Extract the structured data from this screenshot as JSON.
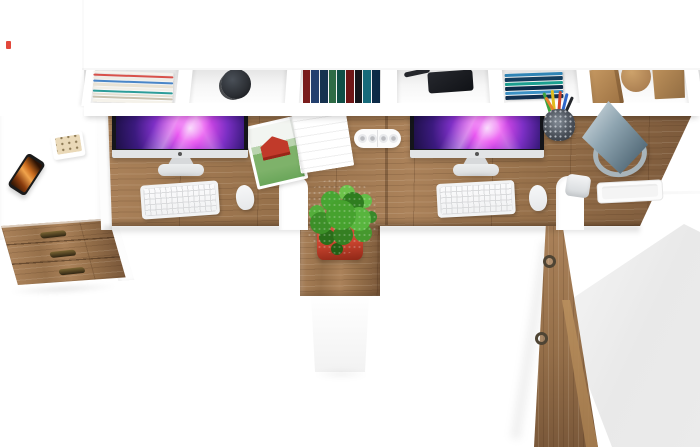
{
  "meta": {
    "subject": "Top-down product photo of a two-person white and oak office desk set with hutch shelving, two iMac computers, plant pedestal, drawer unit and tall side cabinet",
    "visible_text": ""
  },
  "palette": {
    "bg": "#ffffff",
    "wood_hi": "#ab825a",
    "wood_mid": "#96704a",
    "wood_lo": "#7a583a",
    "bezel": "#14151a",
    "imac_silver": "#e2e4e6",
    "stand_silver": "#eceeef",
    "screen_deep": "#1d1046",
    "screen_violet": "#7b2fc4",
    "screen_magenta": "#e94df0",
    "screen_glow": "#f7c8fb",
    "keyboard": "#f2f3f4",
    "mouse": "#f6f7f8",
    "lamp_hi": "#ccd7dd",
    "lamp_mid": "#8ea4b0",
    "lamp_lo": "#526977",
    "lamp_ring": "#a8b4ba",
    "plant_mid": "#46a22e",
    "pot_red": "#c8432e",
    "clip_red": "#c4402c",
    "barn_red": "#c13a2a",
    "field_green": "#7eb26a",
    "treeline_green": "#b9d4ae",
    "sky_white": "#f2f5f1",
    "phone_body": "#1a1a1a",
    "phone_amber": "#d9812f",
    "mug": "#2b2e33",
    "block_tan_hi": "#c79a63",
    "block_tan_lo": "#9c7142",
    "handle_dark": "#46351c",
    "ring_metal": "#4e4434",
    "gray_plane": "#ebebeb",
    "powerstrip": "#fbfbfb",
    "calc_body": "#ead9b8",
    "watermark_red": "#e2483b"
  },
  "series": {
    "magazine_edges": [
      "#f6f3ec",
      "#d8514a",
      "#efece4",
      "#4a86c8",
      "#e8e2d4",
      "#f2efe7",
      "#2e9d9a",
      "#e5e0d2",
      "#c9c2b0",
      "#f5f2ea"
    ],
    "book_spines": [
      "#7a1d1d",
      "#24406e",
      "#16324f",
      "#2e6b45",
      "#0f4f46",
      "#6e1616",
      "#14161c",
      "#176a7a",
      "#0d2b47"
    ],
    "blue_stack": [
      "#2f84b5",
      "#143e5e",
      "#1b9e8f",
      "#0e2c49",
      "#3b90c4",
      "#122f4f"
    ],
    "pencils": [
      "#3fa33f",
      "#e0bd1f",
      "#d0452a",
      "#2e66c9",
      "#24262b",
      "#e8842b"
    ]
  },
  "objects": [
    {
      "id": "hutch-top-panel",
      "label": "white hutch top panel"
    },
    {
      "id": "hutch-compartments",
      "label": "open shelf compartment row"
    },
    {
      "id": "magazine-stack",
      "label": "stack of magazines lying flat"
    },
    {
      "id": "coffee-mug",
      "label": "dark mug seen from above"
    },
    {
      "id": "book-row",
      "label": "row of standing books"
    },
    {
      "id": "black-case",
      "label": "black case on shelf"
    },
    {
      "id": "cable",
      "label": "dark cable end"
    },
    {
      "id": "blue-book-stack",
      "label": "stack of blue books"
    },
    {
      "id": "wood-block-cube",
      "label": "wooden cube ornament"
    },
    {
      "id": "wood-block-cylinder",
      "label": "wooden cylinder ornament"
    },
    {
      "id": "wood-block-wedge",
      "label": "wooden wedge ornament"
    },
    {
      "id": "left-side-desk",
      "label": "white side return desk"
    },
    {
      "id": "smartphone",
      "label": "smartphone with amber screen"
    },
    {
      "id": "notepad",
      "label": "small white pad"
    },
    {
      "id": "calculator",
      "label": "cream desk calculator"
    },
    {
      "id": "wood-desktop",
      "label": "oak double desktop"
    },
    {
      "id": "imac-left",
      "label": "left all-in-one computer"
    },
    {
      "id": "imac-right",
      "label": "right all-in-one computer"
    },
    {
      "id": "keyboard-left",
      "label": "white keyboard"
    },
    {
      "id": "keyboard-right",
      "label": "white keyboard"
    },
    {
      "id": "mouse-left",
      "label": "white mouse"
    },
    {
      "id": "mouse-right",
      "label": "white mouse"
    },
    {
      "id": "open-magazine",
      "label": "open magazine with red barn photo"
    },
    {
      "id": "power-strip",
      "label": "white power strip"
    },
    {
      "id": "pencil-cup",
      "label": "mesh pencil cup with pencils"
    },
    {
      "id": "desk-lamp",
      "label": "blue-gray cone desk lamp with ring base"
    },
    {
      "id": "paper-tray",
      "label": "white paper tray"
    },
    {
      "id": "desk-clamp",
      "label": "silver desk fitting"
    },
    {
      "id": "seat-cutout-left",
      "label": "rounded desktop cutout"
    },
    {
      "id": "seat-cutout-right",
      "label": "rounded desktop cutout"
    },
    {
      "id": "drawer-unit",
      "label": "three-drawer oak cabinet"
    },
    {
      "id": "pedestal",
      "label": "plant pedestal cabinet"
    },
    {
      "id": "potted-plant",
      "label": "green plant in red pot"
    },
    {
      "id": "side-cabinet",
      "label": "tall oak side cabinet with ring pulls"
    },
    {
      "id": "gray-surface",
      "label": "shaded white cabinet top"
    },
    {
      "id": "watermark",
      "label": "small red mark"
    }
  ]
}
